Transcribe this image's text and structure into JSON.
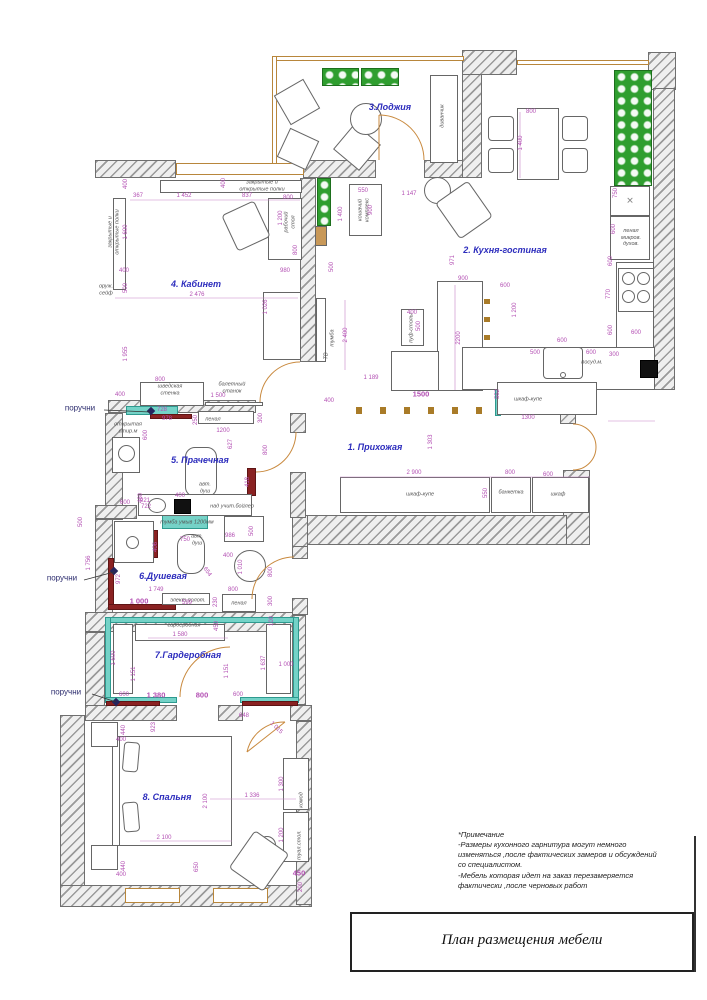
{
  "title_block": {
    "title": "План размещения мебели"
  },
  "notes": {
    "lines": [
      "*Примечание",
      "-Размеры кухонного гарнитура могут немного",
      "изменяться ,после фактических замеров и обсуждений",
      "со специалистом.",
      "-Мебель которая идет на заказ перезамеряется",
      "фактически ,после черновых работ"
    ]
  },
  "rooms": [
    {
      "label": "1. Прихожая",
      "x": 375,
      "y": 447
    },
    {
      "label": "2. Кухня-гостиная",
      "x": 505,
      "y": 250
    },
    {
      "label": "3.Лоджия",
      "x": 390,
      "y": 107
    },
    {
      "label": "4. Кабинет",
      "x": 196,
      "y": 284
    },
    {
      "label": "5. Прачечная",
      "x": 200,
      "y": 460
    },
    {
      "label": "6.Душевая",
      "x": 163,
      "y": 576
    },
    {
      "label": "7.Гардеробная",
      "x": 188,
      "y": 655
    },
    {
      "label": "8. Спальня",
      "x": 167,
      "y": 797
    }
  ],
  "handrails": [
    {
      "label": "поручни",
      "x": 80,
      "y": 408
    },
    {
      "label": "поручни",
      "x": 62,
      "y": 578
    },
    {
      "label": "поручни",
      "x": 66,
      "y": 692
    }
  ],
  "furniture_labels": [
    {
      "t": "диванчик",
      "x": 443,
      "y": 116,
      "r": -90
    },
    {
      "t": "закрытые и\nоткрытые полки",
      "x": 262,
      "y": 186
    },
    {
      "t": "закрытые и\nоткрытые полки",
      "x": 114,
      "y": 232,
      "r": -90
    },
    {
      "t": "оруж.\nсейф",
      "x": 106,
      "y": 290
    },
    {
      "t": "рабочий\nстол",
      "x": 290,
      "y": 222,
      "r": -90
    },
    {
      "t": "шведская\nстенка",
      "x": 170,
      "y": 390
    },
    {
      "t": "балетный\nстанок",
      "x": 232,
      "y": 388
    },
    {
      "t": "открытая\nстир.м",
      "x": 128,
      "y": 428
    },
    {
      "t": "пенал",
      "x": 213,
      "y": 420
    },
    {
      "t": "авт.\nдуш",
      "x": 205,
      "y": 488
    },
    {
      "t": "над учит.бойлер",
      "x": 232,
      "y": 507
    },
    {
      "t": "тумба умыв 1200мм",
      "x": 187,
      "y": 523
    },
    {
      "t": "авт.\nдуш",
      "x": 197,
      "y": 540
    },
    {
      "t": "элект.полот.",
      "x": 188,
      "y": 601
    },
    {
      "t": "пенал",
      "x": 239,
      "y": 604
    },
    {
      "t": "гардеробная",
      "x": 184,
      "y": 626
    },
    {
      "t": "шкаф-купе",
      "x": 528,
      "y": 400
    },
    {
      "t": "шкаф-купе",
      "x": 420,
      "y": 495
    },
    {
      "t": "банкетка",
      "x": 511,
      "y": 493
    },
    {
      "t": "шкаф",
      "x": 558,
      "y": 495
    },
    {
      "t": "комод",
      "x": 302,
      "y": 800,
      "r": -90
    },
    {
      "t": "туал.стол.",
      "x": 300,
      "y": 845,
      "r": -90
    },
    {
      "t": "ТВ",
      "x": 327,
      "y": 356,
      "r": -90
    },
    {
      "t": "тумба",
      "x": 333,
      "y": 338,
      "r": -90
    },
    {
      "t": "кошачий\nкомплекс",
      "x": 364,
      "y": 210,
      "r": -90
    },
    {
      "t": "пуф-столы",
      "x": 412,
      "y": 328,
      "r": -90
    },
    {
      "t": "посуд.м.",
      "x": 592,
      "y": 363
    },
    {
      "t": "пенал\nмикров.\nдухов.",
      "x": 631,
      "y": 238
    }
  ],
  "dimensions": [
    {
      "t": "400",
      "x": 126,
      "y": 184,
      "r": -90
    },
    {
      "t": "367",
      "x": 138,
      "y": 196
    },
    {
      "t": "1 452",
      "x": 184,
      "y": 196
    },
    {
      "t": "837",
      "x": 247,
      "y": 196
    },
    {
      "t": "800",
      "x": 288,
      "y": 198
    },
    {
      "t": "400",
      "x": 224,
      "y": 183,
      "r": -90
    },
    {
      "t": "1 200",
      "x": 281,
      "y": 218,
      "r": -90
    },
    {
      "t": "1 600",
      "x": 126,
      "y": 232,
      "r": -90
    },
    {
      "t": "800",
      "x": 296,
      "y": 250,
      "r": -90
    },
    {
      "t": "980",
      "x": 285,
      "y": 271
    },
    {
      "t": "400",
      "x": 124,
      "y": 271
    },
    {
      "t": "500",
      "x": 126,
      "y": 288,
      "r": -90
    },
    {
      "t": "2 476",
      "x": 197,
      "y": 295
    },
    {
      "t": "1 026",
      "x": 266,
      "y": 307,
      "r": -90
    },
    {
      "t": "1 955",
      "x": 126,
      "y": 354,
      "r": -90
    },
    {
      "t": "400",
      "x": 120,
      "y": 395
    },
    {
      "t": "800",
      "x": 160,
      "y": 380
    },
    {
      "t": "1 500",
      "x": 218,
      "y": 396
    },
    {
      "t": "728",
      "x": 162,
      "y": 410
    },
    {
      "t": "978",
      "x": 167,
      "y": 419
    },
    {
      "t": "250",
      "x": 196,
      "y": 420,
      "r": -90
    },
    {
      "t": "1200",
      "x": 223,
      "y": 431
    },
    {
      "t": "300",
      "x": 261,
      "y": 418,
      "r": -90
    },
    {
      "t": "627",
      "x": 231,
      "y": 444,
      "r": -90
    },
    {
      "t": "800",
      "x": 266,
      "y": 450,
      "r": -90
    },
    {
      "t": "600",
      "x": 146,
      "y": 435,
      "r": -90
    },
    {
      "t": "400",
      "x": 180,
      "y": 496
    },
    {
      "t": "418",
      "x": 248,
      "y": 482,
      "r": -90
    },
    {
      "t": "460",
      "x": 141,
      "y": 498,
      "r": -90
    },
    {
      "t": "600",
      "x": 125,
      "y": 503
    },
    {
      "t": "921",
      "x": 145,
      "y": 501
    },
    {
      "t": "722",
      "x": 146,
      "y": 507
    },
    {
      "t": "550",
      "x": 363,
      "y": 191
    },
    {
      "t": "1 147",
      "x": 409,
      "y": 194
    },
    {
      "t": "900",
      "x": 371,
      "y": 210,
      "r": -90
    },
    {
      "t": "1 400",
      "x": 341,
      "y": 214,
      "r": -90
    },
    {
      "t": "500",
      "x": 332,
      "y": 267,
      "r": -90
    },
    {
      "t": "2 400",
      "x": 346,
      "y": 335,
      "r": -90
    },
    {
      "t": "971",
      "x": 453,
      "y": 260,
      "r": -90
    },
    {
      "t": "900",
      "x": 463,
      "y": 279
    },
    {
      "t": "600",
      "x": 505,
      "y": 286
    },
    {
      "t": "1 200",
      "x": 515,
      "y": 310,
      "r": -90
    },
    {
      "t": "2200",
      "x": 459,
      "y": 338,
      "r": -90
    },
    {
      "t": "400",
      "x": 412,
      "y": 313
    },
    {
      "t": "500",
      "x": 419,
      "y": 326,
      "r": -90
    },
    {
      "t": "800",
      "x": 531,
      "y": 112
    },
    {
      "t": "1 400",
      "x": 521,
      "y": 143,
      "r": -90
    },
    {
      "t": "750",
      "x": 616,
      "y": 193,
      "r": -90
    },
    {
      "t": "600",
      "x": 614,
      "y": 229,
      "r": -90
    },
    {
      "t": "600",
      "x": 611,
      "y": 261,
      "r": -90
    },
    {
      "t": "770",
      "x": 609,
      "y": 294,
      "r": -90
    },
    {
      "t": "600",
      "x": 611,
      "y": 330,
      "r": -90
    },
    {
      "t": "600",
      "x": 636,
      "y": 333
    },
    {
      "t": "600",
      "x": 562,
      "y": 341
    },
    {
      "t": "500",
      "x": 535,
      "y": 353
    },
    {
      "t": "600",
      "x": 591,
      "y": 353
    },
    {
      "t": "300",
      "x": 614,
      "y": 355
    },
    {
      "t": "1500",
      "x": 421,
      "y": 394,
      "b": true
    },
    {
      "t": "1 189",
      "x": 371,
      "y": 378
    },
    {
      "t": "400",
      "x": 329,
      "y": 401
    },
    {
      "t": "1 303",
      "x": 431,
      "y": 442,
      "r": -90
    },
    {
      "t": "552",
      "x": 498,
      "y": 394,
      "r": -90
    },
    {
      "t": "1300",
      "x": 528,
      "y": 418
    },
    {
      "t": "2 900",
      "x": 414,
      "y": 473
    },
    {
      "t": "800",
      "x": 510,
      "y": 473
    },
    {
      "t": "600",
      "x": 548,
      "y": 475
    },
    {
      "t": "550",
      "x": 486,
      "y": 493,
      "r": -90
    },
    {
      "t": "500",
      "x": 81,
      "y": 522,
      "r": -90
    },
    {
      "t": "1 756",
      "x": 89,
      "y": 563,
      "r": -90
    },
    {
      "t": "972",
      "x": 119,
      "y": 579,
      "r": -90
    },
    {
      "t": "406",
      "x": 156,
      "y": 547,
      "r": -90
    },
    {
      "t": "750",
      "x": 185,
      "y": 540
    },
    {
      "t": "986",
      "x": 230,
      "y": 536
    },
    {
      "t": "400",
      "x": 228,
      "y": 556
    },
    {
      "t": "1 010",
      "x": 241,
      "y": 567,
      "r": -90
    },
    {
      "t": "654",
      "x": 207,
      "y": 572,
      "r": 55
    },
    {
      "t": "500",
      "x": 252,
      "y": 531,
      "r": -90
    },
    {
      "t": "1 749",
      "x": 156,
      "y": 590
    },
    {
      "t": "1 000",
      "x": 139,
      "y": 601,
      "b": true
    },
    {
      "t": "599",
      "x": 187,
      "y": 603
    },
    {
      "t": "800",
      "x": 233,
      "y": 590
    },
    {
      "t": "230",
      "x": 216,
      "y": 602,
      "r": -90
    },
    {
      "t": "800",
      "x": 271,
      "y": 572,
      "r": -90
    },
    {
      "t": "300",
      "x": 271,
      "y": 601,
      "r": -90
    },
    {
      "t": "100",
      "x": 272,
      "y": 621,
      "r": -90
    },
    {
      "t": "450",
      "x": 217,
      "y": 626,
      "r": -90
    },
    {
      "t": "1 580",
      "x": 180,
      "y": 635
    },
    {
      "t": "1 600",
      "x": 114,
      "y": 658,
      "r": -90
    },
    {
      "t": "1 151",
      "x": 134,
      "y": 674,
      "r": -90
    },
    {
      "t": "1 151",
      "x": 227,
      "y": 671,
      "r": -90
    },
    {
      "t": "1 637",
      "x": 264,
      "y": 663,
      "r": -90
    },
    {
      "t": "1 000",
      "x": 286,
      "y": 665
    },
    {
      "t": "600",
      "x": 124,
      "y": 695
    },
    {
      "t": "1 380",
      "x": 156,
      "y": 695,
      "b": true
    },
    {
      "t": "800",
      "x": 202,
      "y": 695,
      "b": true
    },
    {
      "t": "600",
      "x": 238,
      "y": 695
    },
    {
      "t": "648",
      "x": 244,
      "y": 716
    },
    {
      "t": "1 015",
      "x": 276,
      "y": 728,
      "r": 45
    },
    {
      "t": "440",
      "x": 124,
      "y": 730,
      "r": -90
    },
    {
      "t": "400",
      "x": 121,
      "y": 740
    },
    {
      "t": "923",
      "x": 154,
      "y": 727,
      "r": -90
    },
    {
      "t": "2 100",
      "x": 206,
      "y": 801,
      "r": -90
    },
    {
      "t": "2 100",
      "x": 164,
      "y": 838
    },
    {
      "t": "1 336",
      "x": 252,
      "y": 796
    },
    {
      "t": "1 300",
      "x": 282,
      "y": 784,
      "r": -90
    },
    {
      "t": "1 200",
      "x": 282,
      "y": 835,
      "r": -90
    },
    {
      "t": "450",
      "x": 299,
      "y": 873,
      "b": true
    },
    {
      "t": "200",
      "x": 301,
      "y": 887,
      "r": -90
    },
    {
      "t": "650",
      "x": 197,
      "y": 867,
      "r": -90
    },
    {
      "t": "440",
      "x": 124,
      "y": 866,
      "r": -90
    },
    {
      "t": "400",
      "x": 121,
      "y": 875
    }
  ],
  "colors": {
    "room_label_blue": "#2d2dbd",
    "dimension_magenta": "#b34fb3",
    "teal_accent": "#74d2c7",
    "handrail_maroon": "#8a2222",
    "door_orange": "#c98a3f",
    "plant_green": "#2f9e2f"
  }
}
